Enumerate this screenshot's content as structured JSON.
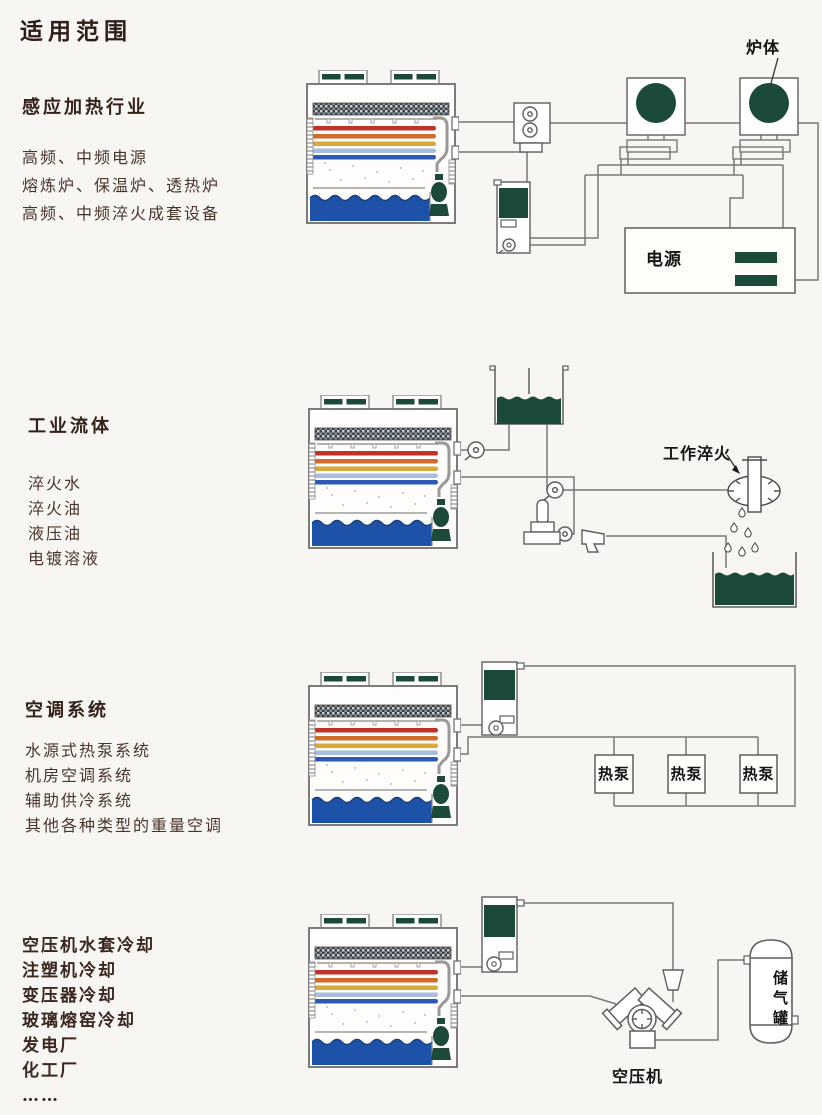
{
  "page": {
    "title": "适用范围"
  },
  "sections": [
    {
      "heading": "感应加热行业",
      "items": [
        "高频、中频电源",
        "熔炼炉、保温炉、透热炉",
        "高频、中频淬火成套设备"
      ]
    },
    {
      "heading": "工业流体",
      "items": [
        "淬火水",
        "淬火油",
        "液压油",
        "电镀溶液"
      ]
    },
    {
      "heading": "空调系统",
      "items": [
        "水源式热泵系统",
        "机房空调系统",
        "辅助供冷系统",
        "其他各种类型的重量空调"
      ]
    },
    {
      "heading": "",
      "items": [
        "空压机水套冷却",
        "注塑机冷却",
        "变压器冷却",
        "玻璃熔窑冷却",
        "发电厂",
        "化工厂",
        "……"
      ]
    }
  ],
  "diagram_labels": {
    "furnace": "炉体",
    "power_supply": "电源",
    "work_quench": "工作淬火",
    "heat_pump_1": "热泵",
    "heat_pump_2": "热泵",
    "heat_pump_3": "热泵",
    "air_compressor": "空压机",
    "air_tank": "储气罐"
  },
  "colors": {
    "dark_green": "#1b4a38",
    "basin_blue": "#1e52a8",
    "coil_red": "#c23127",
    "coil_orange": "#d06c2a",
    "coil_gold": "#d8a83a",
    "coil_light_blue": "#a8bedf",
    "coil_blue": "#2b59b5",
    "heading_brown": "#33211a",
    "body_brown": "#4a342c"
  }
}
